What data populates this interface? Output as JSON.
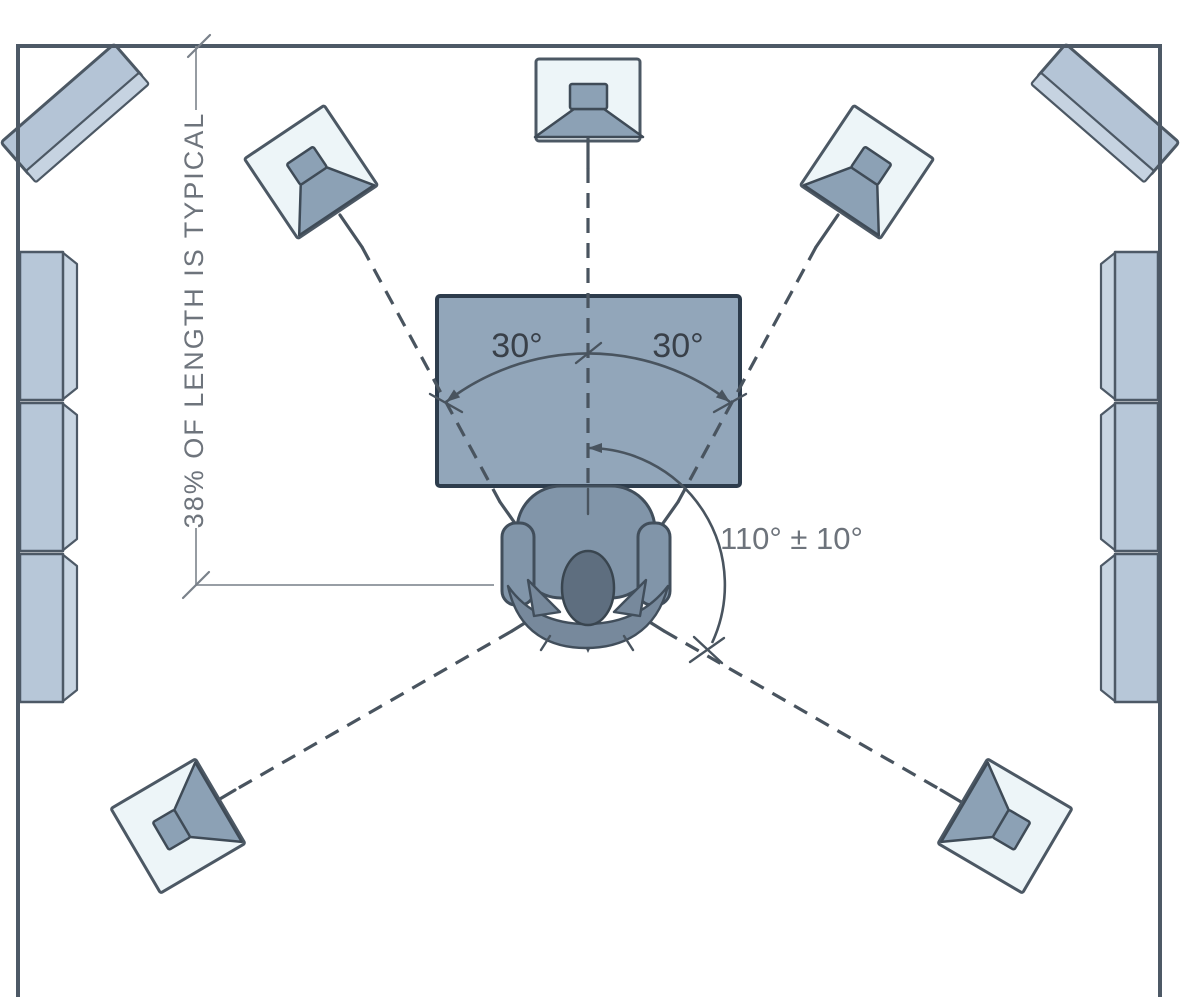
{
  "labels": {
    "front_left_angle": "30°",
    "front_right_angle": "30°",
    "surround_angle": "110° ± 10°",
    "listening_distance": "38% OF LENGTH IS TYPICAL"
  },
  "colors": {
    "background": "#ffffff",
    "wall": "#4d5966",
    "line": "#49545f",
    "speaker_body": "#edf5f8",
    "speaker_cone": "#8ca1b5",
    "panel": "#b7c7d8",
    "panel_bevel": "#c8d5e2",
    "corner_slab": "#b4c4d6",
    "screen_fill": "#92a6ba",
    "screen_border": "#2d3c4c",
    "chair": "#8195a9",
    "chair_dark": "#77899c",
    "head": "#5e6e7f",
    "label_dark": "#394049",
    "label_gray": "#6d737b",
    "dimension_gray": "#8a9198"
  },
  "scene": {
    "type": "surround-speaker-placement-top-view",
    "speakers": [
      "corner-speaker-top-left",
      "front-left-speaker",
      "center-speaker",
      "front-right-speaker",
      "corner-speaker-top-right",
      "surround-left-speaker",
      "surround-right-speaker"
    ],
    "wall_panels": [
      "left-wall-panels",
      "right-wall-panels"
    ],
    "display": "screen",
    "listener": "listener-chair"
  }
}
